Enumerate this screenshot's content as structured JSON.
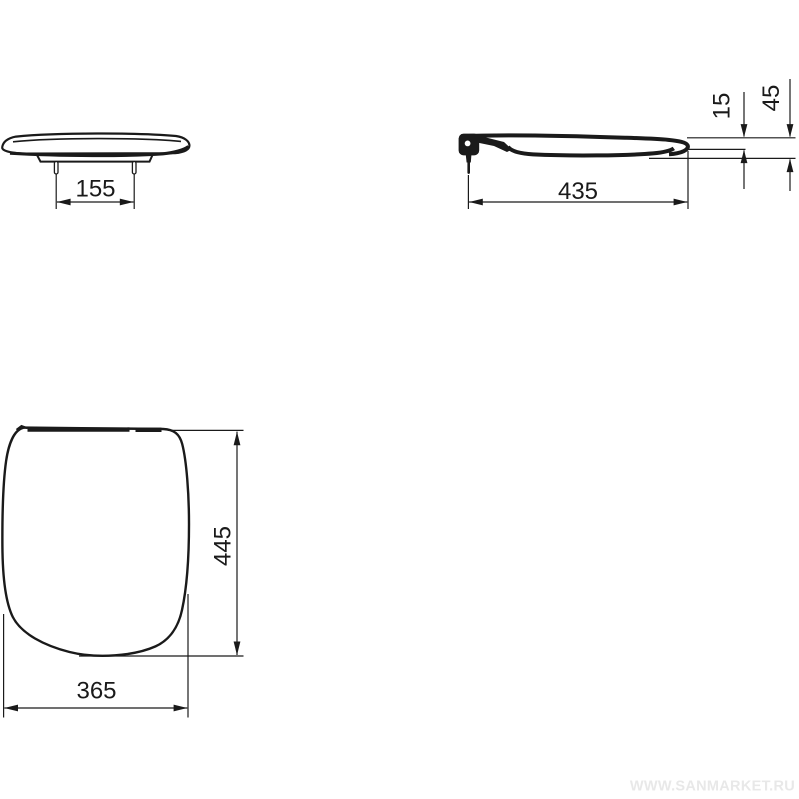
{
  "dimensions": {
    "bolt_spacing": "155",
    "seat_depth": "435",
    "rear_profile_height": "15",
    "total_profile_height": "45",
    "seat_length": "445",
    "seat_width": "365"
  },
  "watermark": "WWW.SANMARKET.RU",
  "colors": {
    "line": "#1a1a1a",
    "background": "#ffffff",
    "watermark": "#e8e8e8"
  }
}
